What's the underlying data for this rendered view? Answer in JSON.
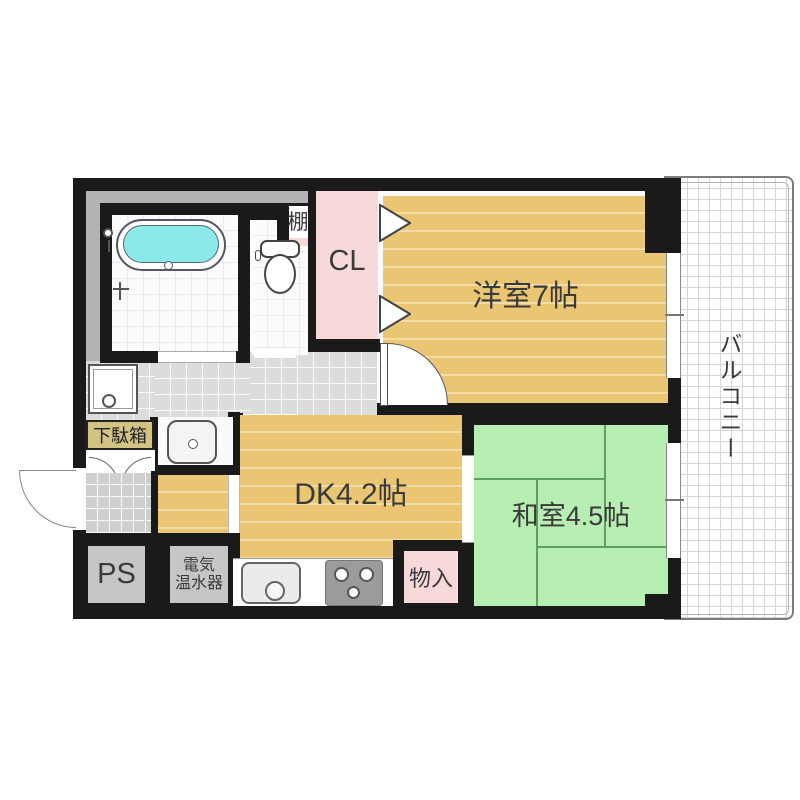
{
  "plan": {
    "type": "apartment-floorplan",
    "rooms": {
      "western_room": {
        "label": "洋室7帖",
        "floor": "wood"
      },
      "japanese_room": {
        "label": "和室4.5帖",
        "floor": "tatami"
      },
      "dining_kitchen": {
        "label": "DK4.2帖",
        "floor": "wood"
      },
      "closet": {
        "label": "CL"
      },
      "balcony": {
        "label": "バルコニー"
      },
      "pipe_space": {
        "label": "PS"
      },
      "water_heater": {
        "label_line1": "電気",
        "label_line2": "温水器"
      },
      "storage": {
        "label": "物入"
      },
      "shoe_cabinet": {
        "label": "下駄箱"
      },
      "shelf": {
        "label": "棚"
      }
    },
    "fixtures": [
      "bathtub",
      "shower-head",
      "wall-faucet",
      "toilet",
      "washbasin",
      "washing-machine-pan",
      "kitchen-sink",
      "gas-stove",
      "entrance-door-swing",
      "room-door-swing",
      "folding-closet-doors",
      "sliding-windows"
    ]
  },
  "theme": {
    "wall": "#1a1a1a",
    "wood_floor": "#eac672",
    "tatami": "#b7eeb2",
    "pink": "#f8d9d9",
    "gray_room": "#c6c6c6",
    "dead_space": "#b3b3b3",
    "hall_tile": "#dcdcdc",
    "entrance_tile": "#cfcfcf",
    "water": "#8ce9e9",
    "text": "#3a3a3a"
  }
}
